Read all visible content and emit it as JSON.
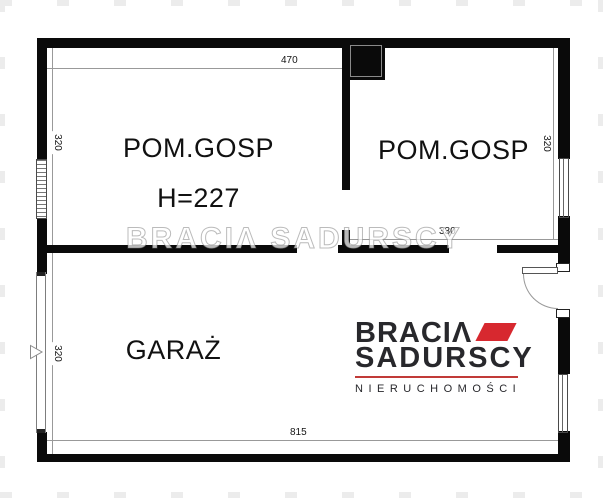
{
  "rooms": {
    "left": {
      "label": "POM.GOSP",
      "height_note": "H=227"
    },
    "right": {
      "label": "POM.GOSP"
    },
    "garage": {
      "label": "GARAŻ"
    }
  },
  "dimensions": {
    "top_width": "470",
    "left_top_height": "320",
    "right_top_height": "320",
    "right_room_width": "330",
    "garage_height": "320",
    "bottom_width": "815"
  },
  "watermark": {
    "text": "BRACIΛ SADURSCY"
  },
  "logo": {
    "line1": "BRACIΛ",
    "line2": "SADURSCY",
    "line3": "NIERUCHOMOŚCI",
    "accent_color": "#d7282f"
  },
  "colors": {
    "wall": "#0a0a0a",
    "dimension_line": "#999999"
  }
}
